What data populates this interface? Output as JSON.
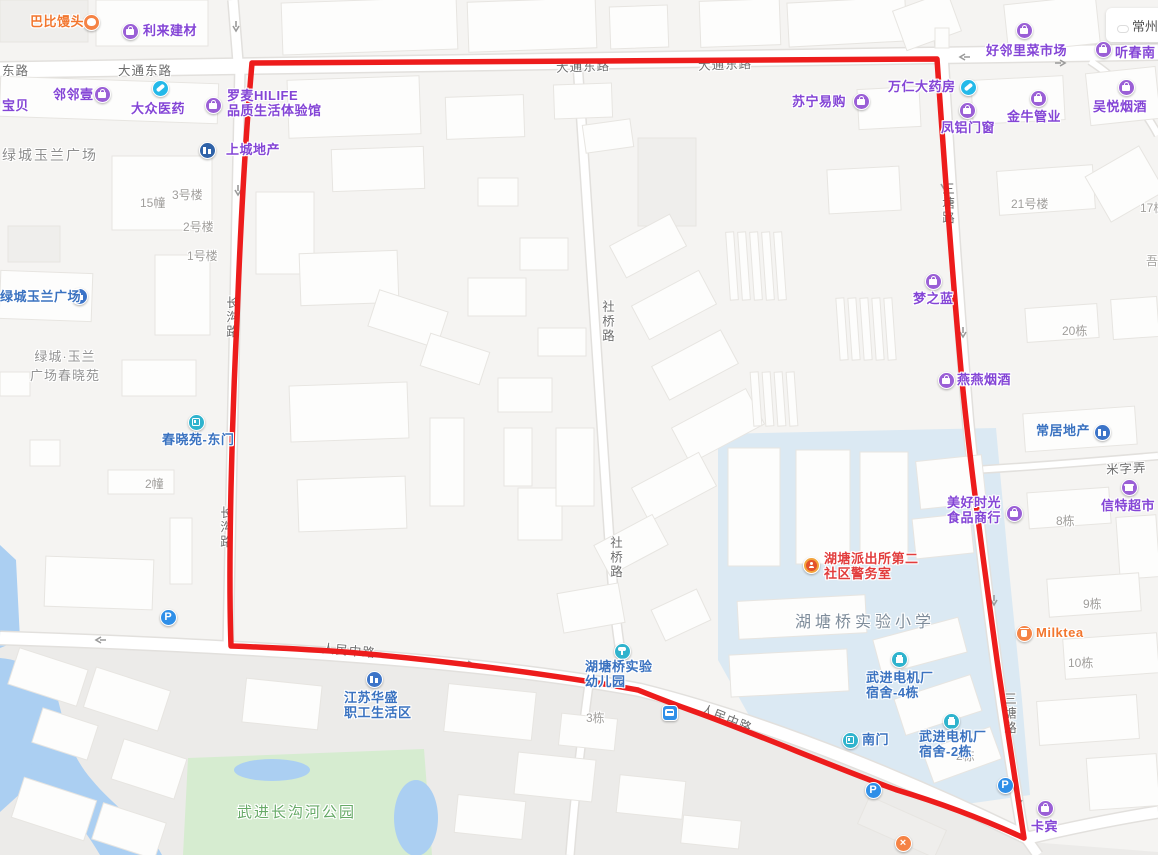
{
  "boundary": {
    "color": "#ed1c1c",
    "description": "red area boundary polygon"
  },
  "colors": {
    "park": "#d6ecd0",
    "water": "#abcff2",
    "school_zone": "#dbe9f3",
    "road_fill": "#ffffff",
    "poi_purple": "#8445d6",
    "poi_blue": "#3a72c0",
    "poi_orange": "#f2762e",
    "poi_red": "#e23d3d"
  },
  "weather": {
    "city": "常州",
    "condition": "partly-cloudy"
  },
  "road_labels": [
    {
      "text": "东路",
      "x": 2,
      "y": 60,
      "v": false,
      "a": 0
    },
    {
      "text": "大通东路",
      "x": 118,
      "y": 60,
      "v": false,
      "a": 0
    },
    {
      "text": "大通东路",
      "x": 556,
      "y": 56,
      "v": false,
      "a": -2
    },
    {
      "text": "大通东路",
      "x": 698,
      "y": 54,
      "v": false,
      "a": -2
    },
    {
      "text": "社桥路",
      "x": 598,
      "y": 300,
      "v": true,
      "a": 0
    },
    {
      "text": "社桥路",
      "x": 606,
      "y": 536,
      "v": true,
      "a": 0
    },
    {
      "text": "长沟路",
      "x": 222,
      "y": 296,
      "v": true,
      "a": 0
    },
    {
      "text": "长沟路",
      "x": 216,
      "y": 506,
      "v": true,
      "a": 0
    },
    {
      "text": "三塘路",
      "x": 938,
      "y": 182,
      "v": true,
      "a": 0
    },
    {
      "text": "三塘路",
      "x": 1000,
      "y": 692,
      "v": true,
      "a": 0
    },
    {
      "text": "人民中路",
      "x": 322,
      "y": 640,
      "v": false,
      "a": 5
    },
    {
      "text": "人民中路",
      "x": 700,
      "y": 708,
      "v": false,
      "a": 22
    },
    {
      "text": "米字弄",
      "x": 1106,
      "y": 458,
      "v": false,
      "a": -3
    }
  ],
  "building_labels": [
    {
      "text": "15幢",
      "x": 140,
      "y": 194
    },
    {
      "text": "3号楼",
      "x": 172,
      "y": 186
    },
    {
      "text": "2号楼",
      "x": 183,
      "y": 218
    },
    {
      "text": "1号楼",
      "x": 187,
      "y": 247
    },
    {
      "text": "2幢",
      "x": 145,
      "y": 475
    },
    {
      "text": "21号楼",
      "x": 1011,
      "y": 195
    },
    {
      "text": "17栋",
      "x": 1140,
      "y": 199
    },
    {
      "text": "吾",
      "x": 1146,
      "y": 252
    },
    {
      "text": "20栋",
      "x": 1062,
      "y": 322
    },
    {
      "text": "8栋",
      "x": 1056,
      "y": 512
    },
    {
      "text": "9栋",
      "x": 1083,
      "y": 595
    },
    {
      "text": "10栋",
      "x": 1068,
      "y": 654
    },
    {
      "text": "3栋",
      "x": 586,
      "y": 709
    },
    {
      "text": "2栋",
      "x": 956,
      "y": 747
    }
  ],
  "area_labels": [
    {
      "lines": [
        "绿城玉兰广场"
      ],
      "variant": "v-estate",
      "x": 2,
      "y": 145
    },
    {
      "lines": [
        "绿城·玉兰",
        "广场春晓苑"
      ],
      "variant": "v-estate-sm",
      "x": 30,
      "y": 346
    },
    {
      "lines": [
        "湖塘桥实验小学"
      ],
      "variant": "v-school",
      "x": 795,
      "y": 608
    },
    {
      "lines": [
        "武进长沟河公园"
      ],
      "variant": "v-park",
      "x": 237,
      "y": 801
    }
  ],
  "pois": [
    {
      "id": "babi-mantou",
      "icon": {
        "type": "bun",
        "color": "orange",
        "x": 91,
        "y": 22
      },
      "label": {
        "lines": [
          "巴比馒头"
        ],
        "color": "orange",
        "x": 30,
        "y": 14
      }
    },
    {
      "id": "lilai-jiancai",
      "icon": {
        "type": "bag",
        "color": "purple",
        "x": 130,
        "y": 31
      },
      "label": {
        "lines": [
          "利来建材"
        ],
        "color": "purple",
        "x": 143,
        "y": 23
      }
    },
    {
      "id": "haolinli-market",
      "icon": {
        "type": "bag",
        "color": "purple",
        "x": 1024,
        "y": 30
      },
      "label": {
        "lines": [
          "好邻里菜市场"
        ],
        "color": "purple",
        "x": 986,
        "y": 43
      }
    },
    {
      "id": "tingchun",
      "icon": {
        "type": "bag",
        "color": "purple",
        "x": 1103,
        "y": 49
      },
      "label": {
        "lines": [
          "听春南"
        ],
        "color": "purple",
        "x": 1115,
        "y": 45
      }
    },
    {
      "id": "wuyue-yanjiu",
      "icon": {
        "type": "bag",
        "color": "purple",
        "x": 1126,
        "y": 87
      },
      "label": {
        "lines": [
          "吴悦烟酒"
        ],
        "color": "purple",
        "x": 1093,
        "y": 99
      }
    },
    {
      "id": "linlinyi",
      "icon": {
        "type": "bag",
        "color": "purple",
        "x": 102,
        "y": 94
      },
      "label": {
        "lines": [
          "邻邻壹"
        ],
        "color": "purple",
        "x": 53,
        "y": 87
      }
    },
    {
      "id": "baobei",
      "label": {
        "lines": [
          "宝贝"
        ],
        "color": "purple",
        "x": 2,
        "y": 98
      }
    },
    {
      "id": "dazhong-yiyao",
      "icon": {
        "type": "pill",
        "color": "cyan",
        "x": 160,
        "y": 88
      },
      "label": {
        "lines": [
          "大众医药"
        ],
        "color": "purple",
        "x": 131,
        "y": 101
      }
    },
    {
      "id": "luomai-hilife",
      "icon": {
        "type": "bag",
        "color": "purple",
        "x": 213,
        "y": 105
      },
      "label": {
        "lines": [
          "罗麦HILIFE",
          "品质生活体验馆"
        ],
        "color": "purple",
        "x": 227,
        "y": 88
      }
    },
    {
      "id": "shangcheng-dichan",
      "icon": {
        "type": "estate",
        "color": "darkblue",
        "x": 207,
        "y": 150
      },
      "label": {
        "lines": [
          "上城地产"
        ],
        "color": "purple",
        "x": 226,
        "y": 142
      }
    },
    {
      "id": "suning-yigou",
      "icon": {
        "type": "bag",
        "color": "purple",
        "x": 861,
        "y": 101
      },
      "label": {
        "lines": [
          "苏宁易购"
        ],
        "color": "purple",
        "x": 792,
        "y": 94
      }
    },
    {
      "id": "wanren-dayaofang",
      "icon": {
        "type": "pill",
        "color": "cyan",
        "x": 968,
        "y": 87
      },
      "label": {
        "lines": [
          "万仁大药房"
        ],
        "color": "purple",
        "x": 888,
        "y": 79
      }
    },
    {
      "id": "fenglv-menchuang",
      "icon": {
        "type": "bag",
        "color": "purple",
        "x": 967,
        "y": 110
      },
      "label": {
        "lines": [
          "凤铝门窗"
        ],
        "color": "purple",
        "x": 941,
        "y": 120
      }
    },
    {
      "id": "jinniu-guanye",
      "icon": {
        "type": "bag",
        "color": "purple",
        "x": 1038,
        "y": 98
      },
      "label": {
        "lines": [
          "金牛管业"
        ],
        "color": "purple",
        "x": 1007,
        "y": 109
      }
    },
    {
      "id": "mengzhilan",
      "icon": {
        "type": "bag",
        "color": "purple",
        "x": 933,
        "y": 281
      },
      "label": {
        "lines": [
          "梦之蓝"
        ],
        "color": "purple",
        "x": 913,
        "y": 291
      }
    },
    {
      "id": "yanyan-yanjiu",
      "icon": {
        "type": "bag",
        "color": "purple",
        "x": 946,
        "y": 380
      },
      "label": {
        "lines": [
          "燕燕烟酒"
        ],
        "color": "purple",
        "x": 957,
        "y": 372
      }
    },
    {
      "id": "changju-dichan",
      "icon": {
        "type": "estate",
        "color": "blue",
        "x": 1102,
        "y": 432
      },
      "label": {
        "lines": [
          "常居地产"
        ],
        "color": "blue",
        "x": 1036,
        "y": 423
      }
    },
    {
      "id": "xinte-chaoshi",
      "icon": {
        "type": "shop",
        "color": "purple",
        "x": 1129,
        "y": 487
      },
      "label": {
        "lines": [
          "信特超市"
        ],
        "color": "purple",
        "x": 1101,
        "y": 498
      }
    },
    {
      "id": "meihao-shiguang",
      "icon": {
        "type": "bag",
        "color": "purple",
        "x": 1014,
        "y": 513
      },
      "label": {
        "lines": [
          "美好时光",
          "食品商行"
        ],
        "color": "purple",
        "x": 947,
        "y": 495
      }
    },
    {
      "id": "milktea",
      "icon": {
        "type": "cup",
        "color": "orange",
        "x": 1024,
        "y": 633
      },
      "label": {
        "lines": [
          "Milktea"
        ],
        "color": "orange",
        "x": 1036,
        "y": 625
      }
    },
    {
      "id": "chunxiaoyuan-east-gate",
      "icon": {
        "type": "gate",
        "color": "teal",
        "x": 196,
        "y": 422
      },
      "label": {
        "lines": [
          "春晓苑-东门"
        ],
        "color": "blue",
        "x": 162,
        "y": 432
      }
    },
    {
      "id": "lvcheng-yulan-plaza",
      "icon": {
        "type": "estate",
        "color": "blue",
        "x": 79,
        "y": 296
      },
      "label": {
        "lines": [
          "绿城玉兰广场"
        ],
        "color": "blue",
        "x": 0,
        "y": 289
      }
    },
    {
      "id": "hutang-police-station",
      "icon": {
        "type": "police",
        "color": "police",
        "x": 811,
        "y": 565
      },
      "label": {
        "lines": [
          "湖塘派出所第二",
          "社区警务室"
        ],
        "color": "red",
        "x": 824,
        "y": 551
      }
    },
    {
      "id": "wujin-dorm-4",
      "icon": {
        "type": "bldg",
        "color": "teal",
        "x": 899,
        "y": 659
      },
      "label": {
        "lines": [
          "武进电机厂",
          "宿舍-4栋"
        ],
        "color": "blue",
        "x": 866,
        "y": 670
      }
    },
    {
      "id": "south-gate",
      "icon": {
        "type": "gate",
        "color": "teal",
        "x": 850,
        "y": 740
      },
      "label": {
        "lines": [
          "南门"
        ],
        "color": "blue",
        "x": 862,
        "y": 732
      }
    },
    {
      "id": "wujin-dorm-2",
      "icon": {
        "type": "bldg",
        "color": "teal",
        "x": 951,
        "y": 721
      },
      "label": {
        "lines": [
          "武进电机厂",
          "宿舍-2栋"
        ],
        "color": "blue",
        "x": 919,
        "y": 729
      }
    },
    {
      "id": "hutangqiao-kindergarten",
      "icon": {
        "type": "sprout",
        "color": "teal",
        "x": 622,
        "y": 651
      },
      "label": {
        "lines": [
          "湖塘桥实验",
          "幼儿园"
        ],
        "color": "blue",
        "x": 585,
        "y": 659
      }
    },
    {
      "id": "jiangsu-huasheng",
      "icon": {
        "type": "estate",
        "color": "blue",
        "x": 374,
        "y": 679
      },
      "label": {
        "lines": [
          "江苏华盛",
          "职工生活区"
        ],
        "color": "blue",
        "x": 344,
        "y": 690
      }
    },
    {
      "id": "kabin",
      "icon": {
        "type": "bag",
        "color": "purple",
        "x": 1045,
        "y": 808
      },
      "label": {
        "lines": [
          "卡宾"
        ],
        "color": "purple",
        "x": 1031,
        "y": 819
      }
    },
    {
      "id": "parking-west",
      "icon": {
        "type": "p",
        "color": "pblue",
        "x": 168,
        "y": 617
      }
    },
    {
      "id": "parking-south",
      "icon": {
        "type": "p",
        "color": "pblue",
        "x": 873,
        "y": 790
      }
    },
    {
      "id": "parking-southeast",
      "icon": {
        "type": "p",
        "color": "pblue",
        "x": 1005,
        "y": 785
      }
    },
    {
      "id": "bus-stop",
      "icon": {
        "type": "bus",
        "color": "bus",
        "x": 670,
        "y": 713
      }
    },
    {
      "id": "closed-marker",
      "icon": {
        "type": "x",
        "color": "orange",
        "x": 903,
        "y": 843
      }
    }
  ]
}
